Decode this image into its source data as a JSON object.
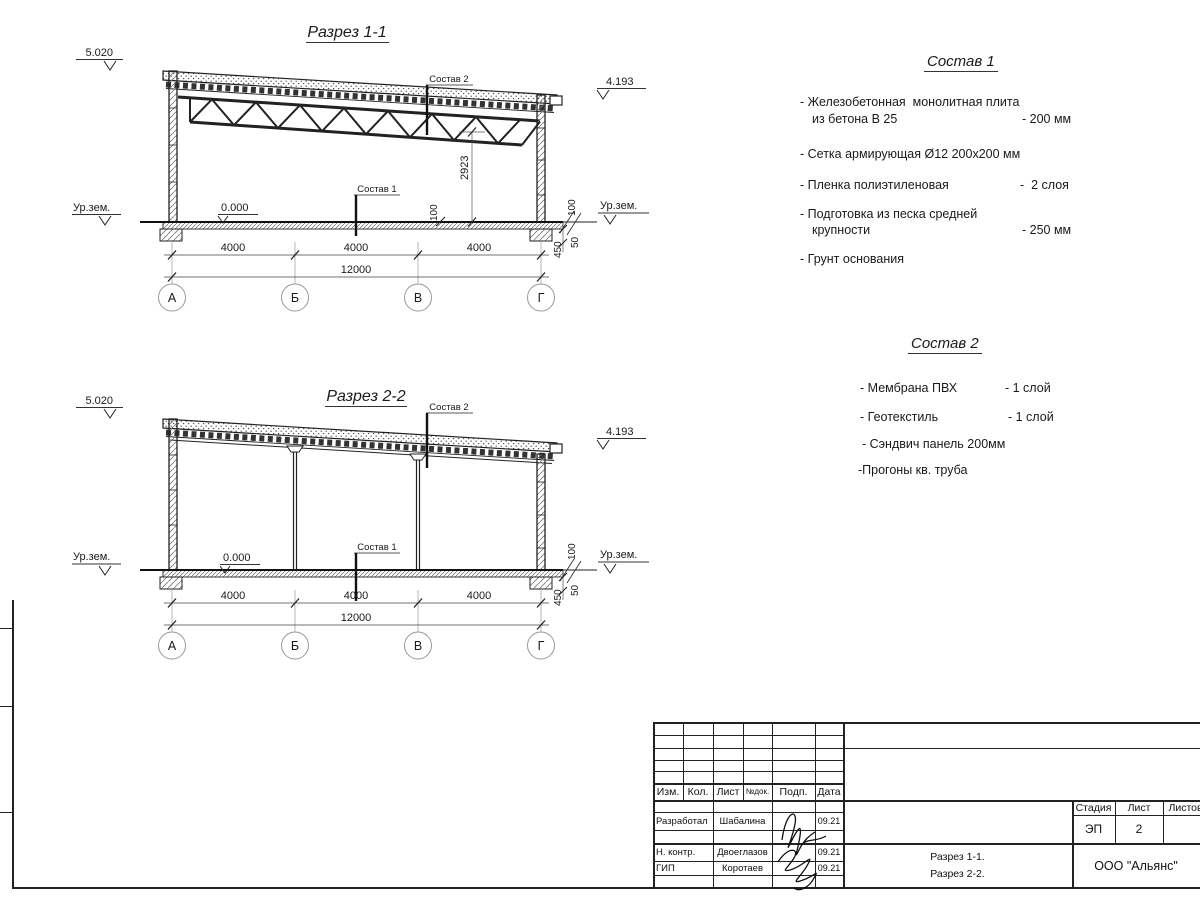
{
  "s1": {
    "title": "Разрез 1-1",
    "elev_tl": "5.020",
    "elev_tr": "4.193",
    "ur_l": "Ур.зем.",
    "ur_r": "Ур.зем.",
    "zero": "0.000",
    "lbl_s1": "Состав 1",
    "lbl_s2": "Состав 2",
    "h": "2923",
    "d100a": "100",
    "d100b": "100",
    "d450": "450",
    "d50": "50",
    "d4k1": "4000",
    "d4k2": "4000",
    "d4k3": "4000",
    "d12k": "12000",
    "axA": "А",
    "axB": "Б",
    "axV": "В",
    "axG": "Г"
  },
  "s2": {
    "title": "Разрез 2-2",
    "elev_tl": "5.020",
    "elev_tr": "4.193",
    "ur_l": "Ур.зем.",
    "ur_r": "Ур.зем.",
    "zero": "0.000",
    "lbl_s1": "Состав 1",
    "lbl_s2": "Состав 2",
    "d100b": "100",
    "d450": "450",
    "d50": "50",
    "d4k1": "4000",
    "d4k2": "4000",
    "d4k3": "4000",
    "d12k": "12000",
    "axA": "А",
    "axB": "Б",
    "axV": "В",
    "axG": "Г"
  },
  "comp1": {
    "title": "Состав 1",
    "i1l1": "- Железобетонная  монолитная плита",
    "i1l2": "из бетона В 25",
    "i1v": "- 200 мм",
    "i2": "- Сетка армирующая Ø12 200x200 мм",
    "i3": "- Пленка полиэтиленовая",
    "i3v": "-  2 слоя",
    "i4l1": "- Подготовка из песка средней",
    "i4l2": "крупности",
    "i4v": "- 250 мм",
    "i5": "- Грунт основания"
  },
  "comp2": {
    "title": "Состав 2",
    "i1": "- Мембрана ПВХ",
    "i1v": "- 1 слой",
    "i2": "- Геотекстиль",
    "i2v": "- 1 слой",
    "i3": "- Сэндвич панель 200мм",
    "i4": "-Прогоны кв. труба"
  },
  "tb": {
    "h_izm": "Изм.",
    "h_kol": "Кол.",
    "h_list": "Лист",
    "h_ndok": "№док.",
    "h_podp": "Подп.",
    "h_data": "Дата",
    "r1_role": "Разработал",
    "r1_name": "Шабалина",
    "r1_date": "09.21",
    "r2_role": "Н. контр.",
    "r2_name": "Двоеглазов",
    "r2_date": "09.21",
    "r3_role": "ГИП",
    "r3_name": "Коротаев",
    "r3_date": "09.21",
    "h_stadia": "Стадия",
    "h_list2": "Лист",
    "h_listov": "Листов",
    "v_stadia": "ЭП",
    "v_list": "2",
    "doc1": "Разрез 1-1.",
    "doc2": "Разрез 2-2.",
    "org": "ООО \"Альянс\""
  }
}
